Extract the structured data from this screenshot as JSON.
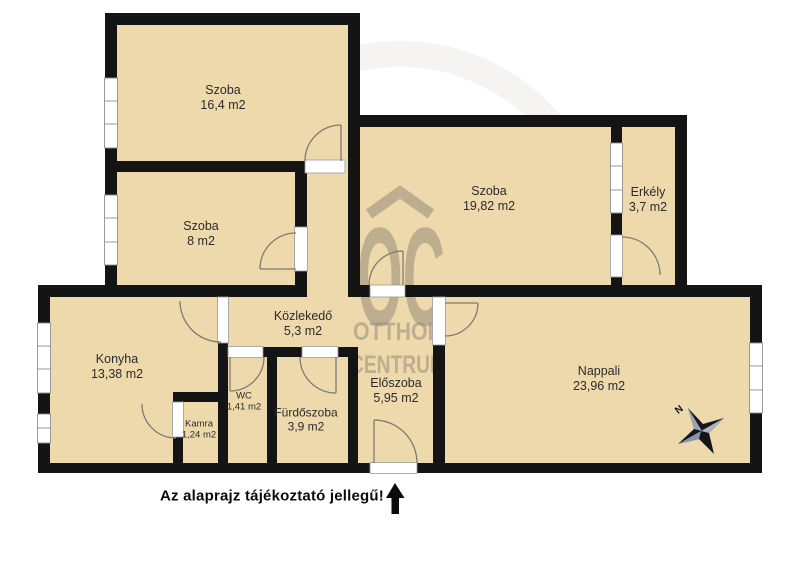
{
  "plan": {
    "note": "Az alaprajz tájékoztató jellegű!",
    "compass": {
      "north_label": "N"
    },
    "watermark": {
      "logo_text": "OC",
      "line1": "OTTHON",
      "line2": "CENTRUM"
    },
    "icons": {
      "compass": "compass-rose",
      "entrance_arrow": "up-arrow",
      "watermark_roof": "roof-chevron"
    },
    "colors": {
      "floor": "#eed9ad",
      "wall": "#141414",
      "watermark": "#8d8373",
      "white": "#ffffff"
    },
    "rooms": [
      {
        "name": "Szoba",
        "area": "16,4 m2"
      },
      {
        "name": "Szoba",
        "area": "8 m2"
      },
      {
        "name": "Szoba",
        "area": "19,82 m2"
      },
      {
        "name": "Erkély",
        "area": "3,7 m2"
      },
      {
        "name": "Közlekedő",
        "area": "5,3 m2"
      },
      {
        "name": "Konyha",
        "area": "13,38 m2"
      },
      {
        "name": "WC",
        "area": "1,41 m2"
      },
      {
        "name": "Kamra",
        "area": "1,24 m2"
      },
      {
        "name": "Fürdőszoba",
        "area": "3,9 m2"
      },
      {
        "name": "Előszoba",
        "area": "5,95 m2"
      },
      {
        "name": "Nappali",
        "area": "23,96 m2"
      }
    ]
  }
}
